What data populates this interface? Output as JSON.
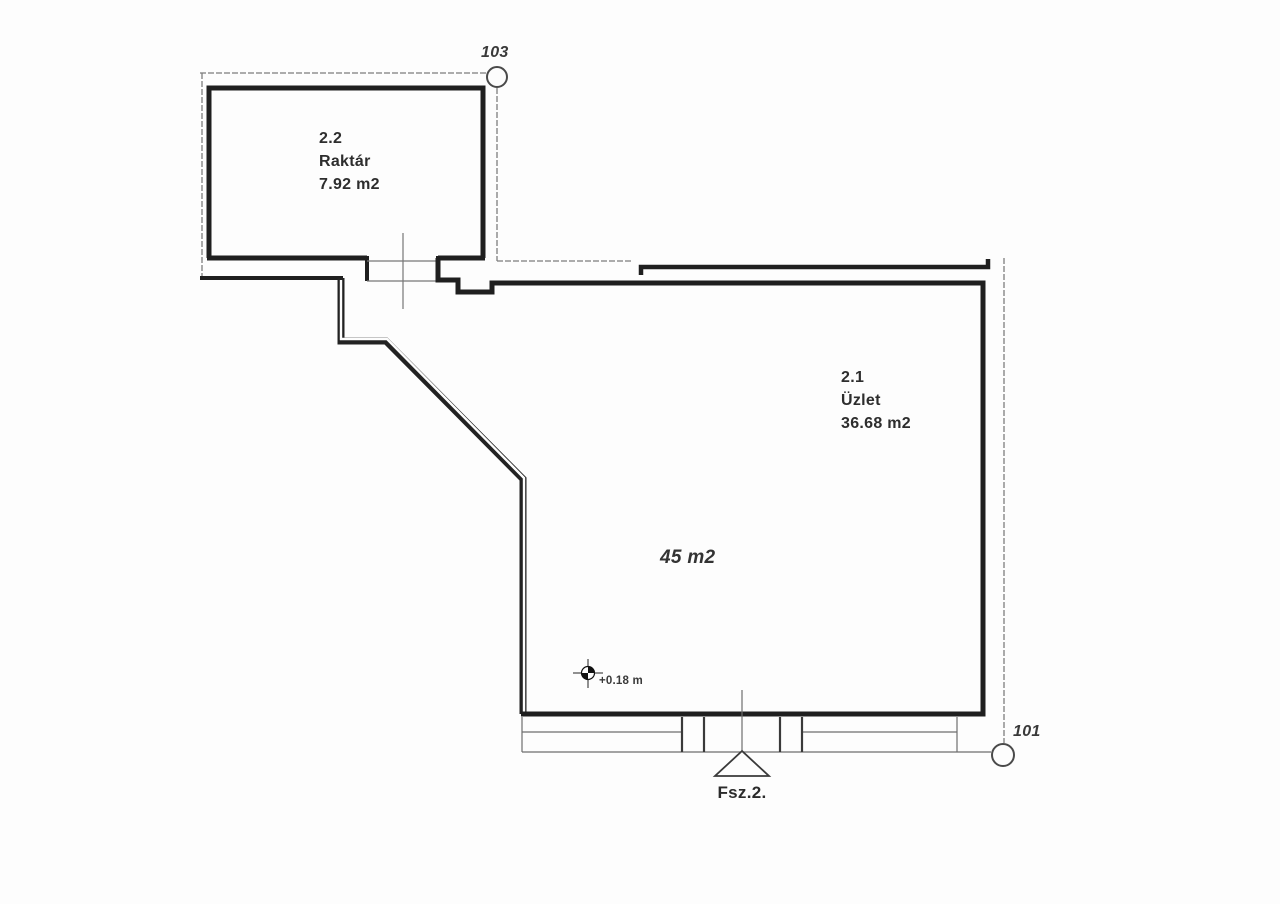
{
  "plan": {
    "rooms": [
      {
        "id": "2.2",
        "name": "Raktár",
        "area": "7.92 m2"
      },
      {
        "id": "2.1",
        "name": "Üzlet",
        "area": "36.68 m2"
      }
    ],
    "total_area_label": "45 m2",
    "survey_points": [
      {
        "label": "103"
      },
      {
        "label": "101"
      }
    ],
    "benchmark": {
      "elevation_label": "+0.18 m"
    },
    "entrance": {
      "label": "Fsz.2."
    }
  },
  "colors": {
    "wall": "#1f1f1f",
    "thin_line": "#7a7a7a",
    "background": "#fdfdfd",
    "text": "#2d2d2d"
  }
}
